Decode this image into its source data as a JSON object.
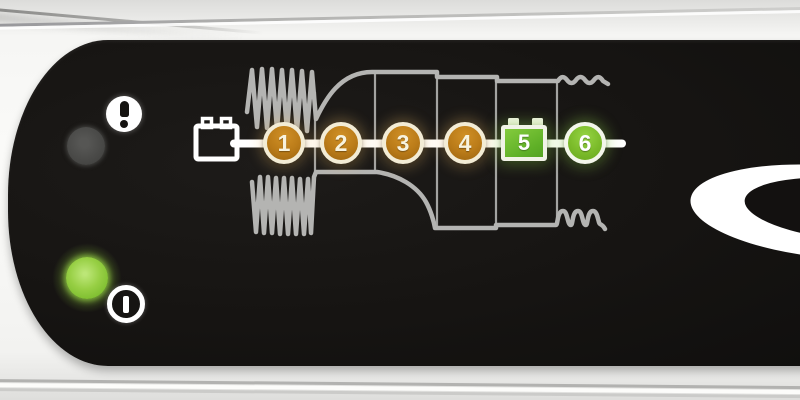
{
  "device": {
    "type": "battery-charger-control-panel",
    "body_color": "#f6f6f4",
    "panel_color": "#151311"
  },
  "indicators": {
    "error": {
      "icon": "exclamation-circle",
      "led_state": "off",
      "led_color": "#474745"
    },
    "power": {
      "icon": "power-circle-bar",
      "led_state": "on",
      "led_color": "#8cc63e"
    }
  },
  "stage_diagram": {
    "description": "6-step charging program with charge voltage/current curves",
    "waveform_color": "#b4b4b2",
    "divider_color": "#a3a3a1",
    "line_color": "#ffffff",
    "battery_icon": "battery-outline",
    "stages": [
      {
        "label": "1",
        "shape": "circle",
        "fill": "#bb7c19",
        "ring": "#f3ecd5"
      },
      {
        "label": "2",
        "shape": "circle",
        "fill": "#bb7c19",
        "ring": "#f3ecd5"
      },
      {
        "label": "3",
        "shape": "circle",
        "fill": "#bb7c19",
        "ring": "#f3ecd5"
      },
      {
        "label": "4",
        "shape": "circle",
        "fill": "#bb7c19",
        "ring": "#f3ecd5"
      },
      {
        "label": "5",
        "shape": "battery",
        "fill": "#5fb027",
        "ring": "#f1f3e6"
      },
      {
        "label": "6",
        "shape": "circle",
        "fill": "#7bbb2a",
        "ring": "#f3f6ea"
      }
    ]
  },
  "brand": {
    "logo": "ellipse-swoosh-logo",
    "logo_color": "#ffffff"
  }
}
